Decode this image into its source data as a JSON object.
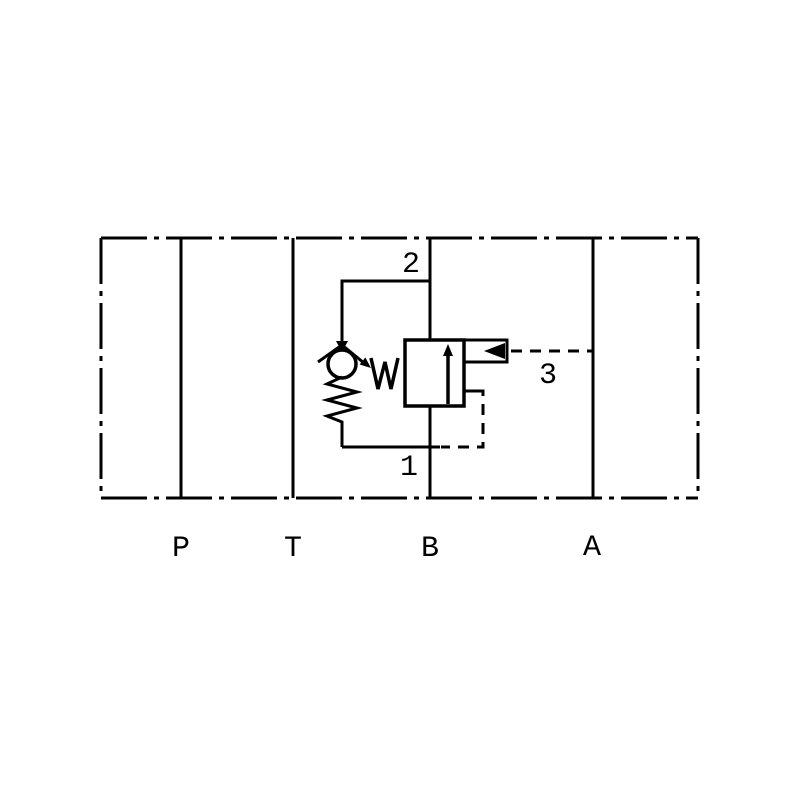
{
  "diagram": {
    "ports": {
      "p": "P",
      "t": "T",
      "b": "B",
      "a": "A"
    },
    "nodes": {
      "n1": "1",
      "n2": "2",
      "n3": "3"
    },
    "colors": {
      "line": "#000000",
      "background": "#ffffff"
    }
  }
}
